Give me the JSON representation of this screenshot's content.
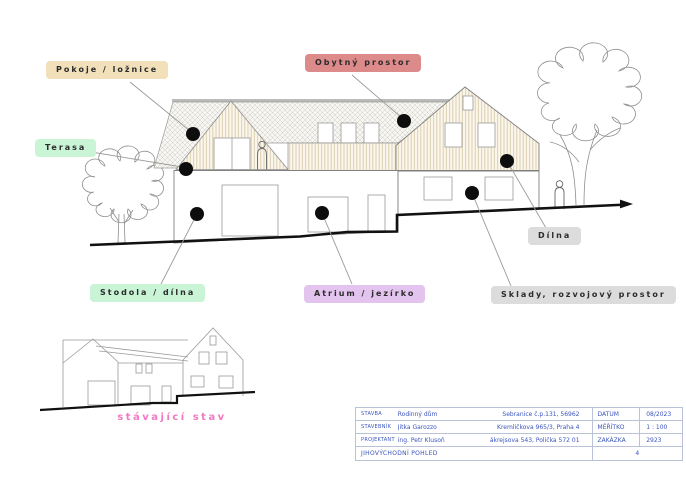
{
  "callouts": {
    "pokoje": {
      "text": "Pokoje / ložnice",
      "bg": "#f2e0bb"
    },
    "obytny": {
      "text": "Obytný prostor",
      "bg": "#dd8a8a"
    },
    "terasa": {
      "text": "Terasa",
      "bg": "#c9f4d6"
    },
    "stodola": {
      "text": "Stodola / dílna",
      "bg": "#c9f4d6"
    },
    "atrium": {
      "text": "Atrium / jezírko",
      "bg": "#e3c4ee"
    },
    "dilna": {
      "text": "Dílna",
      "bg": "#dcdcdc"
    },
    "sklady": {
      "text": "Sklady, rozvojový prostor",
      "bg": "#dcdcdc"
    }
  },
  "caption": {
    "existing_state": "stávající stav",
    "color": "#f178c5"
  },
  "title_block": {
    "text_color": "#3a55bd",
    "rows": [
      {
        "label": "STAVBA",
        "value": "Rodinný dům",
        "address": "Sebranice č.p.131, 56962",
        "meta_label": "DATUM",
        "meta_value": "08/2023"
      },
      {
        "label": "STAVEBNÍK",
        "value": "Jitka Garozzo",
        "address": "Kremličkova 965/3, Praha 4",
        "meta_label": "MĚŘÍTKO",
        "meta_value": "1 : 100"
      },
      {
        "label": "PROJEKTANT",
        "value": "ing. Petr Klusoň",
        "address": "Zákrejsova 543, Polička 572 01",
        "meta_label": "ZAKÁZKA",
        "meta_value": "2923"
      }
    ],
    "footer_left": "JIHOVÝCHODNÍ POHLED",
    "footer_right": "4"
  }
}
